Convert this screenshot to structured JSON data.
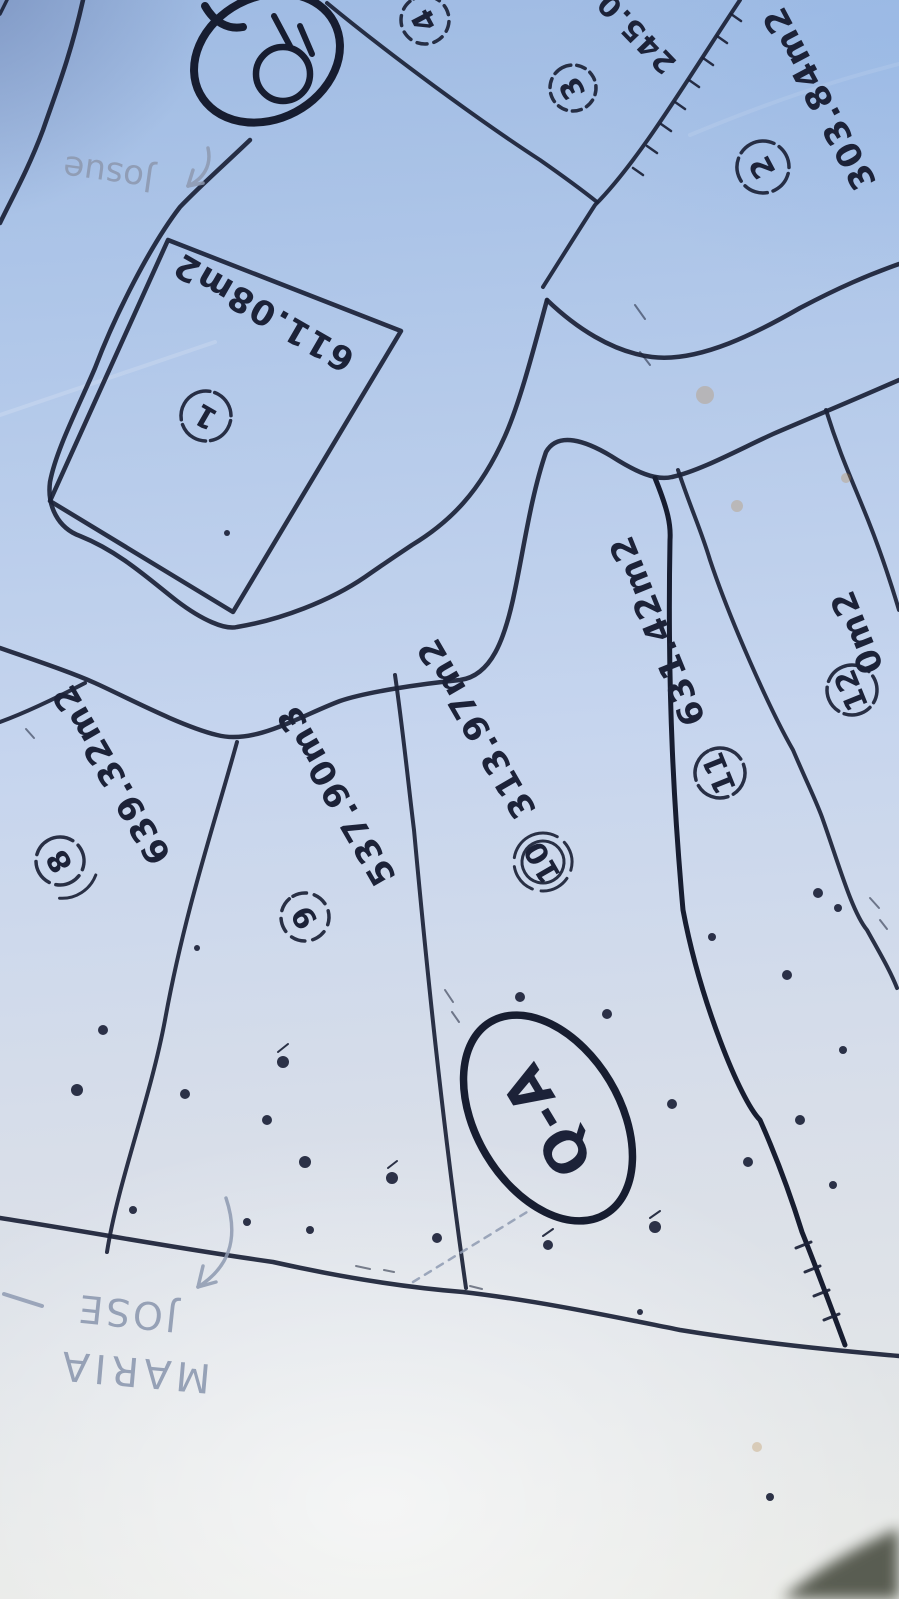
{
  "parcels": [
    {
      "id": "1",
      "area": "611.08m2"
    },
    {
      "id": "2",
      "area": "303.84m2"
    },
    {
      "id": "3",
      "area": ""
    },
    {
      "id": "4",
      "area": ""
    },
    {
      "id": "8",
      "area": "639.32m2"
    },
    {
      "id": "9",
      "area": "537.90m3"
    },
    {
      "id": "10",
      "area": "313.97m2"
    },
    {
      "id": "11",
      "area": "631.42m2"
    },
    {
      "id": "12",
      "area": "0m2"
    }
  ],
  "labels": {
    "block_q": "Q",
    "block_qa": "Q-A",
    "edge_measure": "245.0"
  },
  "handwriting": {
    "top_name": "Josue",
    "bottom_name_line1": "JOSE",
    "bottom_name_line2": "MARIA"
  },
  "colors": {
    "ink": "#1c2238",
    "pencil": "#8e9ab1",
    "paper_top": "#9fbbe3",
    "paper_mid": "#c6d5ee",
    "paper_bottom": "#e9eae6",
    "corner_shadow": "#4a4e42",
    "stain": "#b9884e"
  }
}
